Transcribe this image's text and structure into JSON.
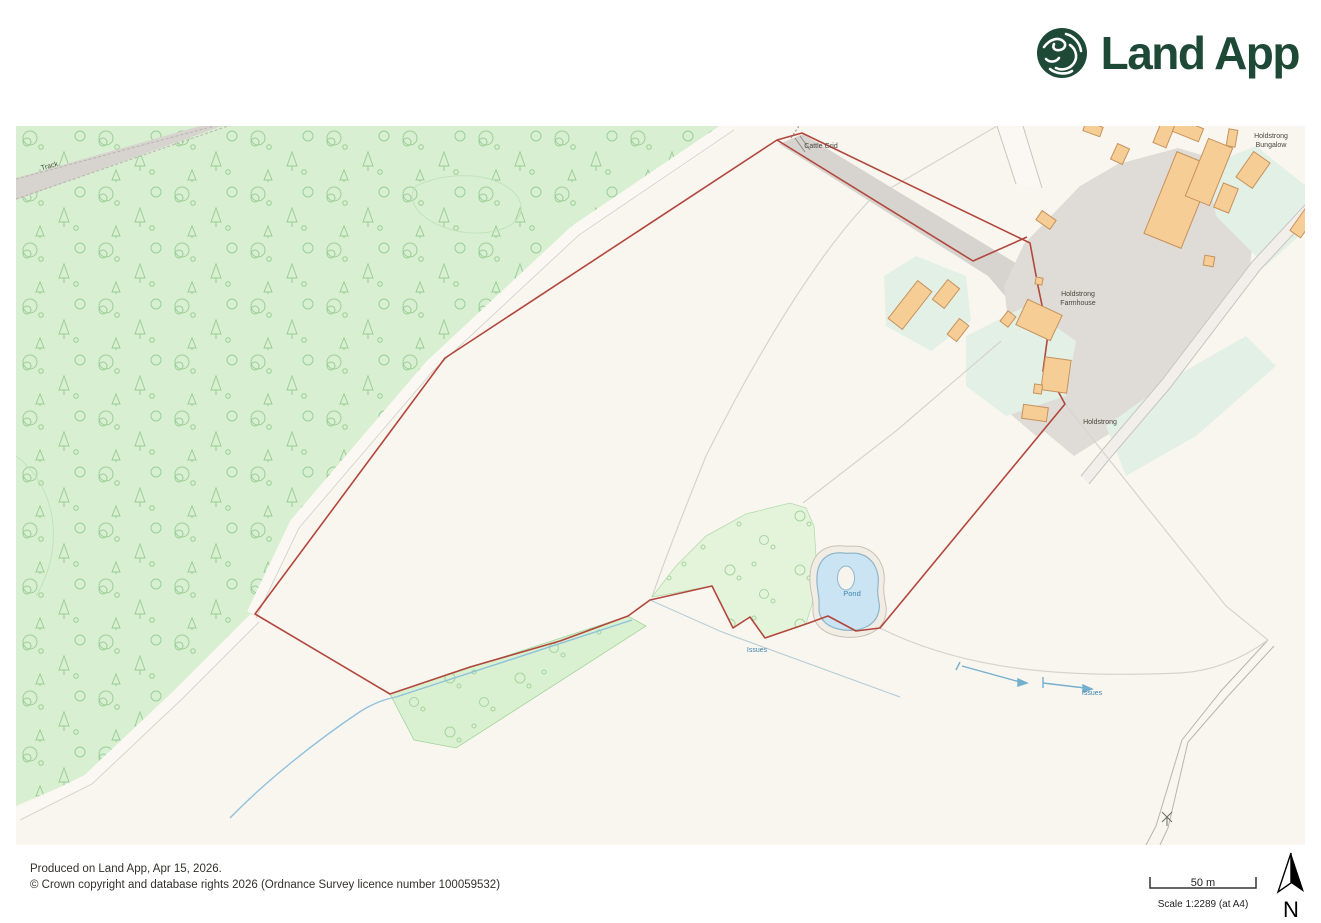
{
  "logo": {
    "text": "Land App",
    "color": "#1D4936"
  },
  "footer": {
    "produced": "Produced on Land App, Apr 15, 2026.",
    "copyright": "© Crown copyright and database rights 2026 (Ordnance Survey licence number 100059532)"
  },
  "scale": {
    "distance": "50 m",
    "text": "Scale 1:2289 (at A4)"
  },
  "compass": {
    "label": "N"
  },
  "map": {
    "labels": {
      "track": "Track",
      "cattle_grid": "Cattle Grid",
      "farmhouse_line1": "Holdstrong",
      "farmhouse_line2": "Farmhouse",
      "bungalow_line1": "Holdstrong",
      "bungalow_line2": "Bungalow",
      "holdstrong": "Holdstrong",
      "pond": "Pond",
      "issues_1": "Issues",
      "issues_2": "Issues"
    },
    "colors": {
      "map_background": "#F9F6F0",
      "woodland": "#D8F0D1",
      "woodland_glyph": "#9BCD98",
      "scrub": "#E4F4DB",
      "garden": "#E2F0E6",
      "yard": "#DFDBD6",
      "track": "#D7D3CF",
      "road_edge": "#C8C4BF",
      "field_line": "#D7D3CE",
      "boundary_red": "#B2473D",
      "building_fill": "#F7CD96",
      "building_stroke": "#C6925B",
      "pond_fill": "#CBE4F4",
      "pond_stroke": "#8FB6C9",
      "water_blue": "#74AFCE",
      "label_dark": "#4A463E",
      "label_water": "#3F84AC"
    },
    "buildings": [
      {
        "cx": 1163,
        "cy": 74,
        "w": 40,
        "h": 88,
        "rot": 22
      },
      {
        "cx": 1193,
        "cy": 46,
        "w": 26,
        "h": 62,
        "rot": 22
      },
      {
        "cx": 1210,
        "cy": 72,
        "w": 16,
        "h": 26,
        "rot": 22
      },
      {
        "cx": 1148,
        "cy": 8,
        "w": 14,
        "h": 24,
        "rot": 22
      },
      {
        "cx": 1172,
        "cy": 4,
        "w": 28,
        "h": 14,
        "rot": 22
      },
      {
        "cx": 1104,
        "cy": 28,
        "w": 13,
        "h": 17,
        "rot": 25
      },
      {
        "cx": 1237,
        "cy": 44,
        "w": 20,
        "h": 31,
        "rot": 35
      },
      {
        "cx": 1287,
        "cy": 97,
        "w": 13,
        "h": 27,
        "rot": 35
      },
      {
        "cx": 1193,
        "cy": 135,
        "w": 10,
        "h": 10,
        "rot": 10
      },
      {
        "cx": 1216,
        "cy": 12,
        "w": 9,
        "h": 17,
        "rot": 10
      },
      {
        "cx": 1077,
        "cy": 3,
        "w": 18,
        "h": 10,
        "rot": 20
      },
      {
        "cx": 894,
        "cy": 179,
        "w": 18,
        "h": 48,
        "rot": 38
      },
      {
        "cx": 930,
        "cy": 168,
        "w": 15,
        "h": 25,
        "rot": 38
      },
      {
        "cx": 942,
        "cy": 204,
        "w": 12,
        "h": 20,
        "rot": 38
      },
      {
        "cx": 992,
        "cy": 193,
        "w": 10,
        "h": 13,
        "rot": 38
      },
      {
        "cx": 1023,
        "cy": 194,
        "w": 38,
        "h": 28,
        "rot": 25
      },
      {
        "cx": 1040,
        "cy": 249,
        "w": 26,
        "h": 33,
        "rot": 8
      },
      {
        "cx": 1022,
        "cy": 263,
        "w": 8,
        "h": 9,
        "rot": 8
      },
      {
        "cx": 1019,
        "cy": 287,
        "w": 25,
        "h": 14,
        "rot": 8
      },
      {
        "cx": 1030,
        "cy": 94,
        "w": 11,
        "h": 17,
        "rot": -55
      },
      {
        "cx": 1023,
        "cy": 155,
        "w": 7,
        "h": 7,
        "rot": 10
      }
    ]
  }
}
